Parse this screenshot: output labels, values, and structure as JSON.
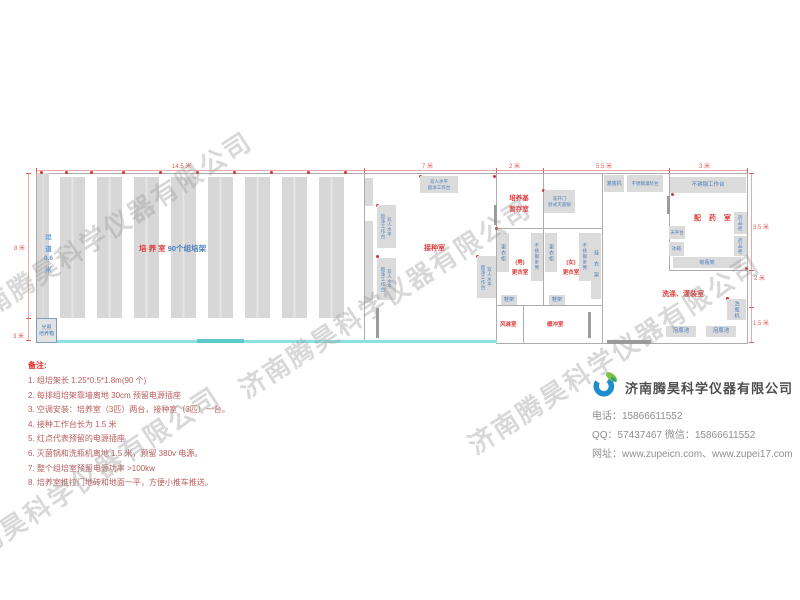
{
  "watermark": "济南腾昊科学仪器有限公司",
  "dims": {
    "top_w1": "14.5 米",
    "top_w2": "7 米",
    "top_w3": "2 米",
    "top_w4": "5.5 米",
    "top_w5": "3 米",
    "left_h1": "8 米",
    "left_h2": "3 米",
    "right_h1": "3.5 米",
    "right_h2": "2 米",
    "right_h3": "1.5 米"
  },
  "rooms": {
    "culture": {
      "name": "培 养 室",
      "racks": "90个组培架",
      "aisle": [
        "过",
        "道",
        "0.6",
        "米"
      ],
      "incubator": [
        "光照",
        "培养箱"
      ]
    },
    "inoculation": {
      "name": "接种室",
      "bench": [
        "双人水平",
        "超净工作台"
      ]
    },
    "medium_storage": [
      "培养基",
      "暂存室"
    ],
    "sterilizer": [
      "双开门",
      "卧式灭菌锅"
    ],
    "filling": {
      "machine": "灌装机",
      "table": "不锈钢灌装台"
    },
    "pharmacy": {
      "name": "配 药 室",
      "worktable": "不锈钢工作台",
      "balance": "天平台",
      "fridge": "冰箱",
      "cabinet": "药品柜",
      "bottle_rack": "晾瓶架"
    },
    "washing": {
      "name": "洗涤、灌装室",
      "washer": "洗瓶机",
      "pool": "泡瓶池"
    },
    "changing": {
      "male": [
        "(男)",
        "更衣室"
      ],
      "female": [
        "(女)",
        "更衣室"
      ],
      "locker": "更衣柜",
      "bench": "不锈钢条凳",
      "hanger": "挂衣架",
      "shoe_rack": "鞋架"
    },
    "air_shower": "风淋室",
    "buffer": "缓冲室"
  },
  "notes": {
    "title": "备注:",
    "items": [
      "1.  组培架长 1.25*0.5*1.8m(90 个)",
      "2.  每排组培架靠墙离地 30cm 预留电源插座",
      "3.  空调安装：培养室（3匹）两台，接种室（3匹）一台。",
      "4.  接种工作台长为 1.5 米",
      "5.  红点代表预留的电源插座",
      "6.  灭菌锅和洗瓶机离地 1.5 米，预留 380v 电源。",
      "7.  整个组培室预留电源功率 >100kw",
      "8.  培养室推拉门地砖和地面一平，方便小推车推送。"
    ]
  },
  "company": {
    "name": "济南腾昊科学仪器有限公司",
    "phone_line": "电话：15866611552",
    "qq_line": "QQ：57437467    微信：15866611552",
    "web_line": "网址：www.zupeicn.com、www.zupei17.com"
  }
}
